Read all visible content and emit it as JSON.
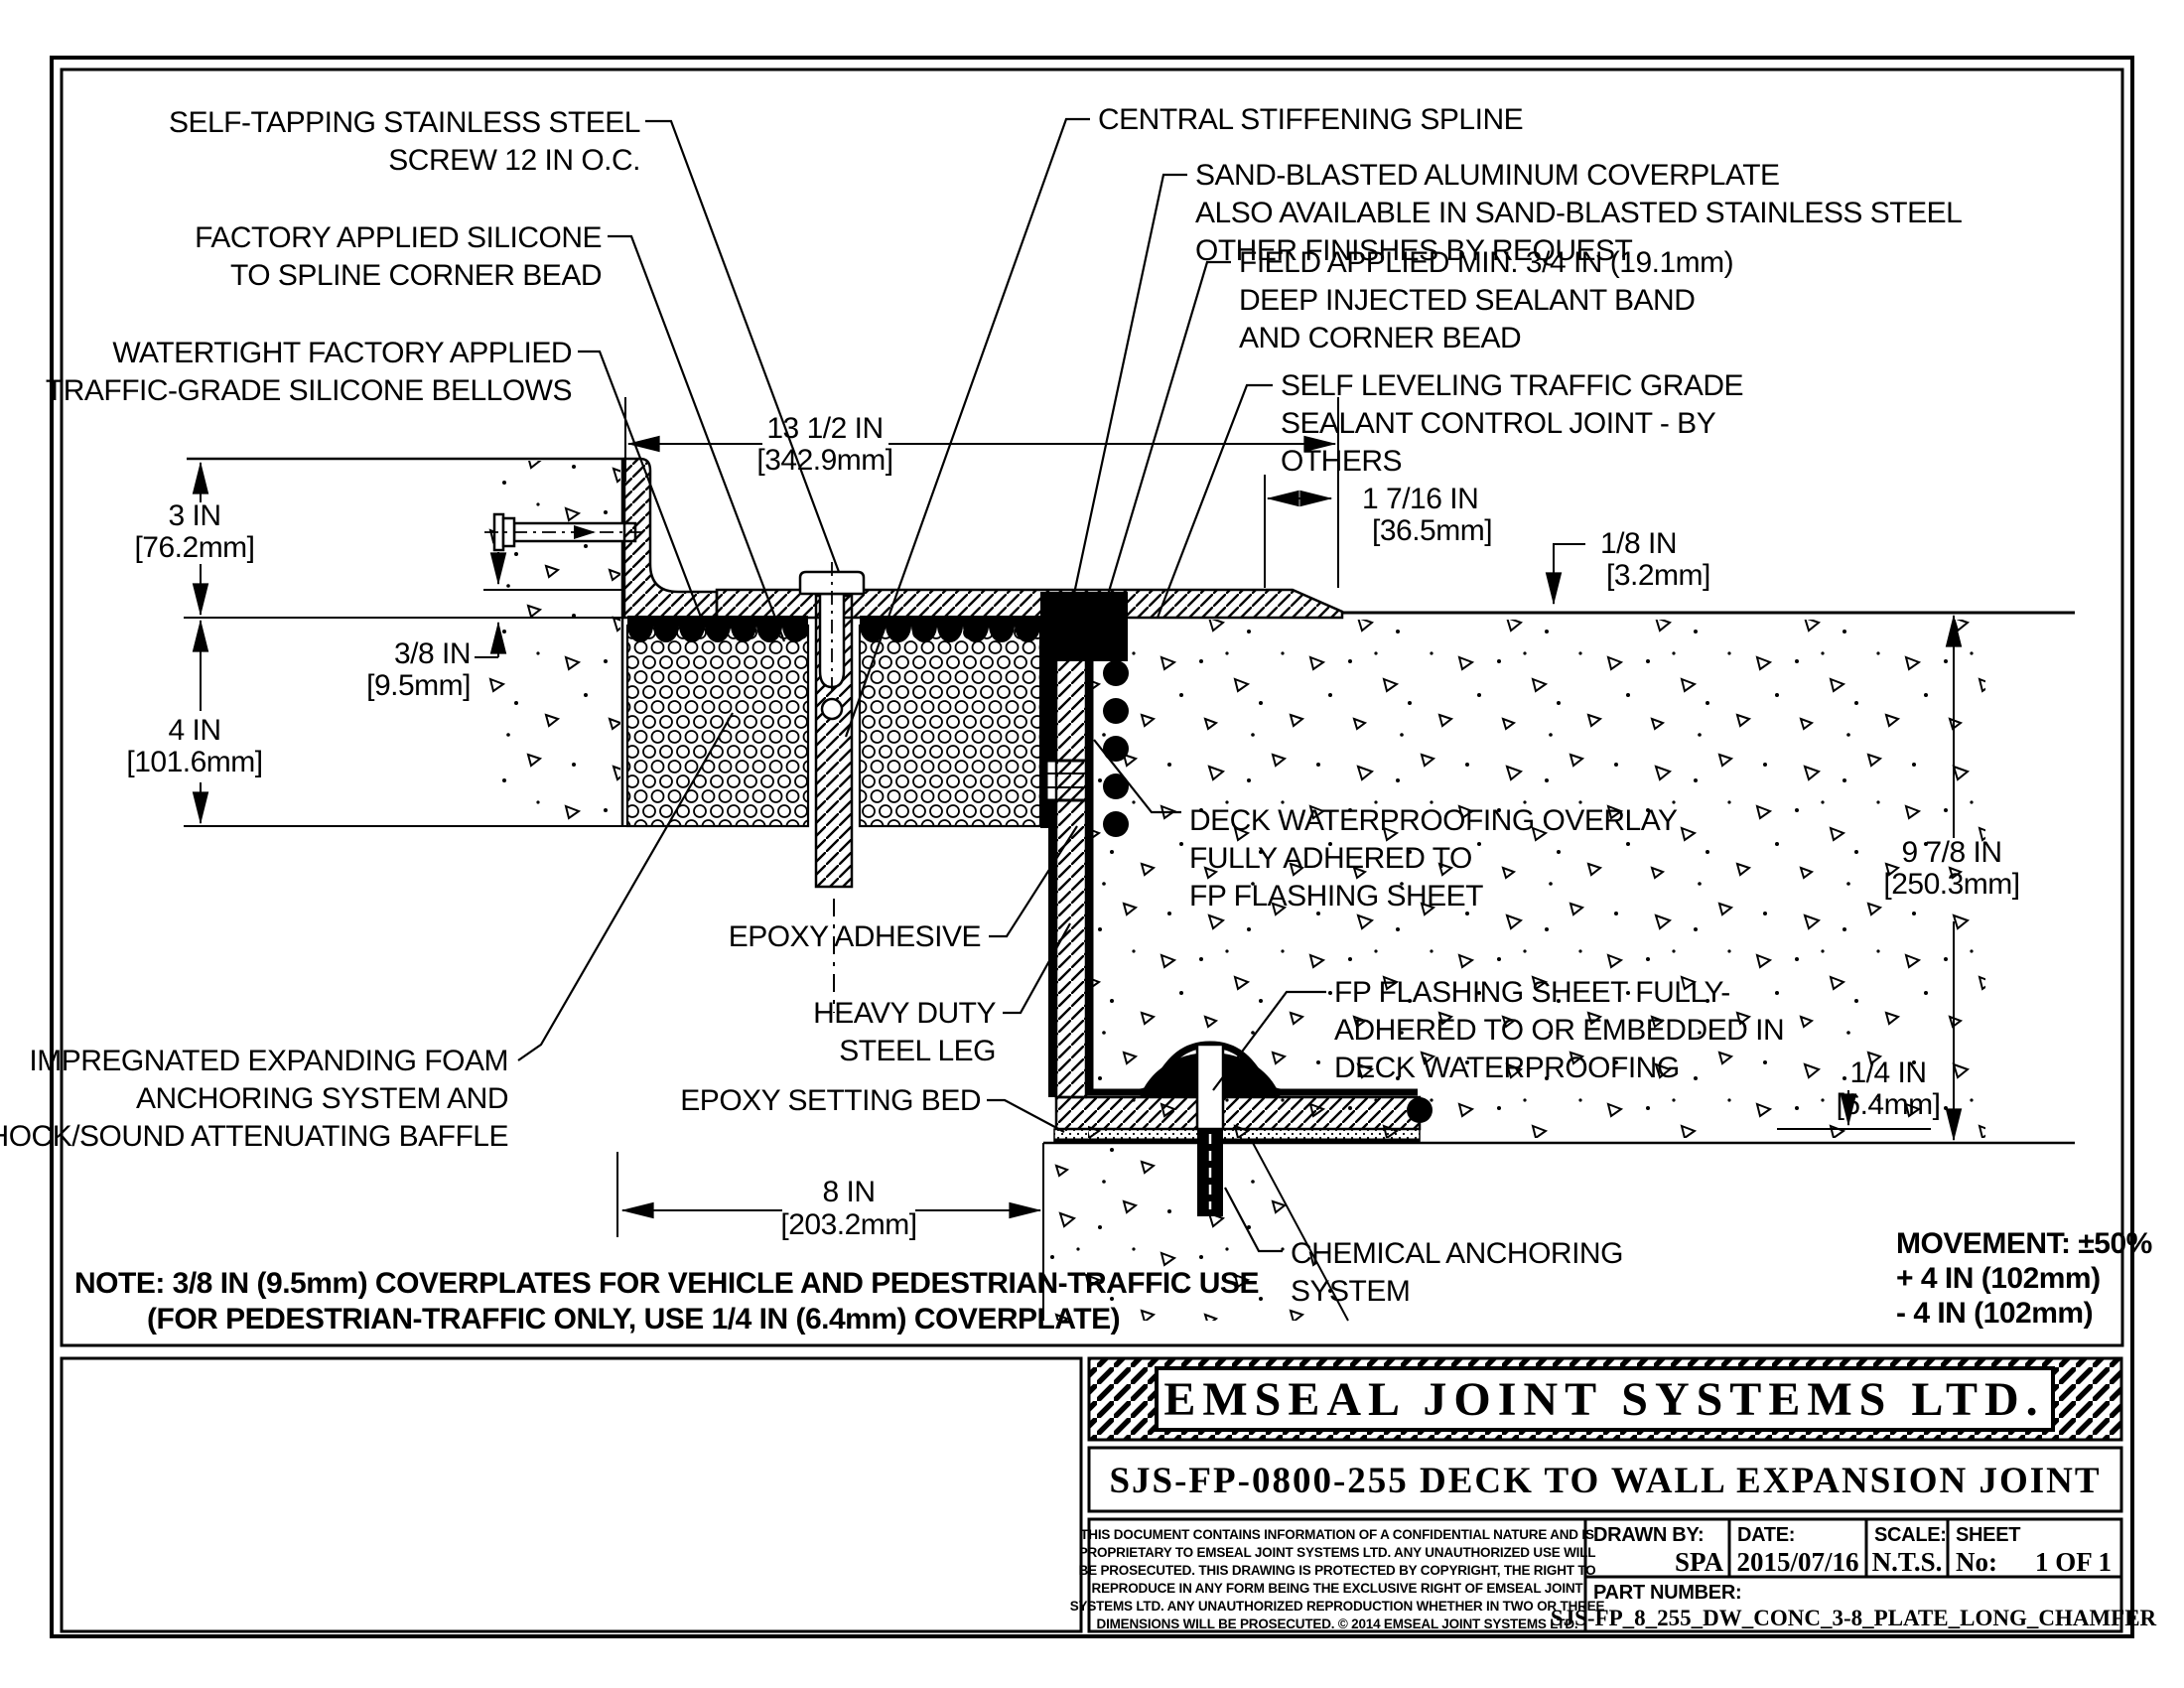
{
  "drawing": {
    "labels": {
      "self_tapping": [
        "SELF-TAPPING STAINLESS STEEL",
        "SCREW 12 IN O.C."
      ],
      "factory_silicone": [
        "FACTORY APPLIED SILICONE",
        "TO SPLINE CORNER BEAD"
      ],
      "watertight_bellows": [
        "WATERTIGHT FACTORY APPLIED",
        "TRAFFIC-GRADE SILICONE BELLOWS"
      ],
      "central_spline": [
        "CENTRAL STIFFENING SPLINE"
      ],
      "coverplate": [
        "SAND-BLASTED ALUMINUM COVERPLATE",
        "ALSO AVAILABLE IN SAND-BLASTED STAINLESS STEEL",
        "OTHER FINISHES BY REQUEST"
      ],
      "field_applied": [
        "FIELD APPLIED MIN. 3/4 IN (19.1mm)",
        "DEEP INJECTED SEALANT BAND",
        "AND CORNER BEAD"
      ],
      "self_leveling": [
        "SELF LEVELING TRAFFIC GRADE",
        "SEALANT CONTROL JOINT - BY",
        "OTHERS"
      ],
      "deck_waterproofing": [
        "DECK WATERPROOFING OVERLAY",
        "FULLY ADHERED TO",
        "FP FLASHING SHEET"
      ],
      "fp_flashing": [
        "FP FLASHING SHEET FULLY-",
        "ADHERED TO OR EMBEDDED IN",
        "DECK WATERPROOFING"
      ],
      "epoxy_adhesive": [
        "EPOXY ADHESIVE"
      ],
      "heavy_duty_leg": [
        "HEAVY DUTY",
        "STEEL LEG"
      ],
      "epoxy_setting_bed": [
        "EPOXY SETTING BED"
      ],
      "impregnated_foam": [
        "IMPREGNATED EXPANDING FOAM",
        "ANCHORING SYSTEM AND",
        "SHOCK/SOUND ATTENUATING BAFFLE"
      ],
      "chemical_anchor": [
        "CHEMICAL ANCHORING",
        "SYSTEM"
      ]
    },
    "dimensions": {
      "top_width": [
        "13 1/2 IN",
        "[342.9mm]"
      ],
      "plate_edge": [
        "1 7/16 IN",
        "[36.5mm]"
      ],
      "plate_lip": [
        "1/8 IN",
        "[3.2mm]"
      ],
      "wall_upstand": [
        "3 IN",
        "[76.2mm]"
      ],
      "plate_thickness": [
        "3/8 IN",
        "[9.5mm]"
      ],
      "foam_depth": [
        "4 IN",
        "[101.6mm]"
      ],
      "joint_opening": [
        "8 IN",
        "[203.2mm]"
      ],
      "wall_height": [
        "9 7/8 IN",
        "[250.3mm]"
      ],
      "bed_thickness": [
        "1/4 IN",
        "[6.4mm]"
      ]
    },
    "movement": [
      "MOVEMENT: ±50%",
      "+ 4 IN (102mm)",
      "- 4 IN (102mm)"
    ],
    "note": [
      "NOTE: 3/8 IN (9.5mm) COVERPLATES FOR VEHICLE AND PEDESTRIAN-TRAFFIC USE",
      "(FOR PEDESTRIAN-TRAFFIC ONLY, USE 1/4 IN (6.4mm) COVERPLATE)"
    ]
  },
  "title_block": {
    "company": "EMSEAL JOINT SYSTEMS LTD.",
    "drawing_title": "SJS-FP-0800-255 DECK TO WALL EXPANSION JOINT",
    "fields": {
      "drawn_by_label": "DRAWN BY:",
      "drawn_by": "SPA",
      "date_label": "DATE:",
      "date": "2015/07/16",
      "scale_label": "SCALE:",
      "scale": "N.T.S.",
      "sheet_label": "SHEET",
      "sheet_no_label": "No:",
      "sheet_no": "1 OF 1",
      "part_number_label": "PART NUMBER:",
      "part_number": "SJS-FP_8_255_DW_CONC_3-8_PLATE_LONG_CHAMFER"
    },
    "legal": [
      "THIS DOCUMENT CONTAINS INFORMATION OF A CONFIDENTIAL NATURE AND IS",
      "PROPRIETARY TO EMSEAL JOINT SYSTEMS LTD. ANY UNAUTHORIZED USE WILL",
      "BE PROSECUTED. THIS DRAWING IS PROTECTED BY COPYRIGHT, THE RIGHT TO",
      "REPRODUCE IN ANY FORM BEING THE EXCLUSIVE RIGHT OF EMSEAL JOINT",
      "SYSTEMS LTD. ANY UNAUTHORIZED REPRODUCTION WHETHER IN TWO OR THREE",
      "DIMENSIONS WILL BE PROSECUTED. © 2014 EMSEAL JOINT SYSTEMS LTD."
    ]
  }
}
